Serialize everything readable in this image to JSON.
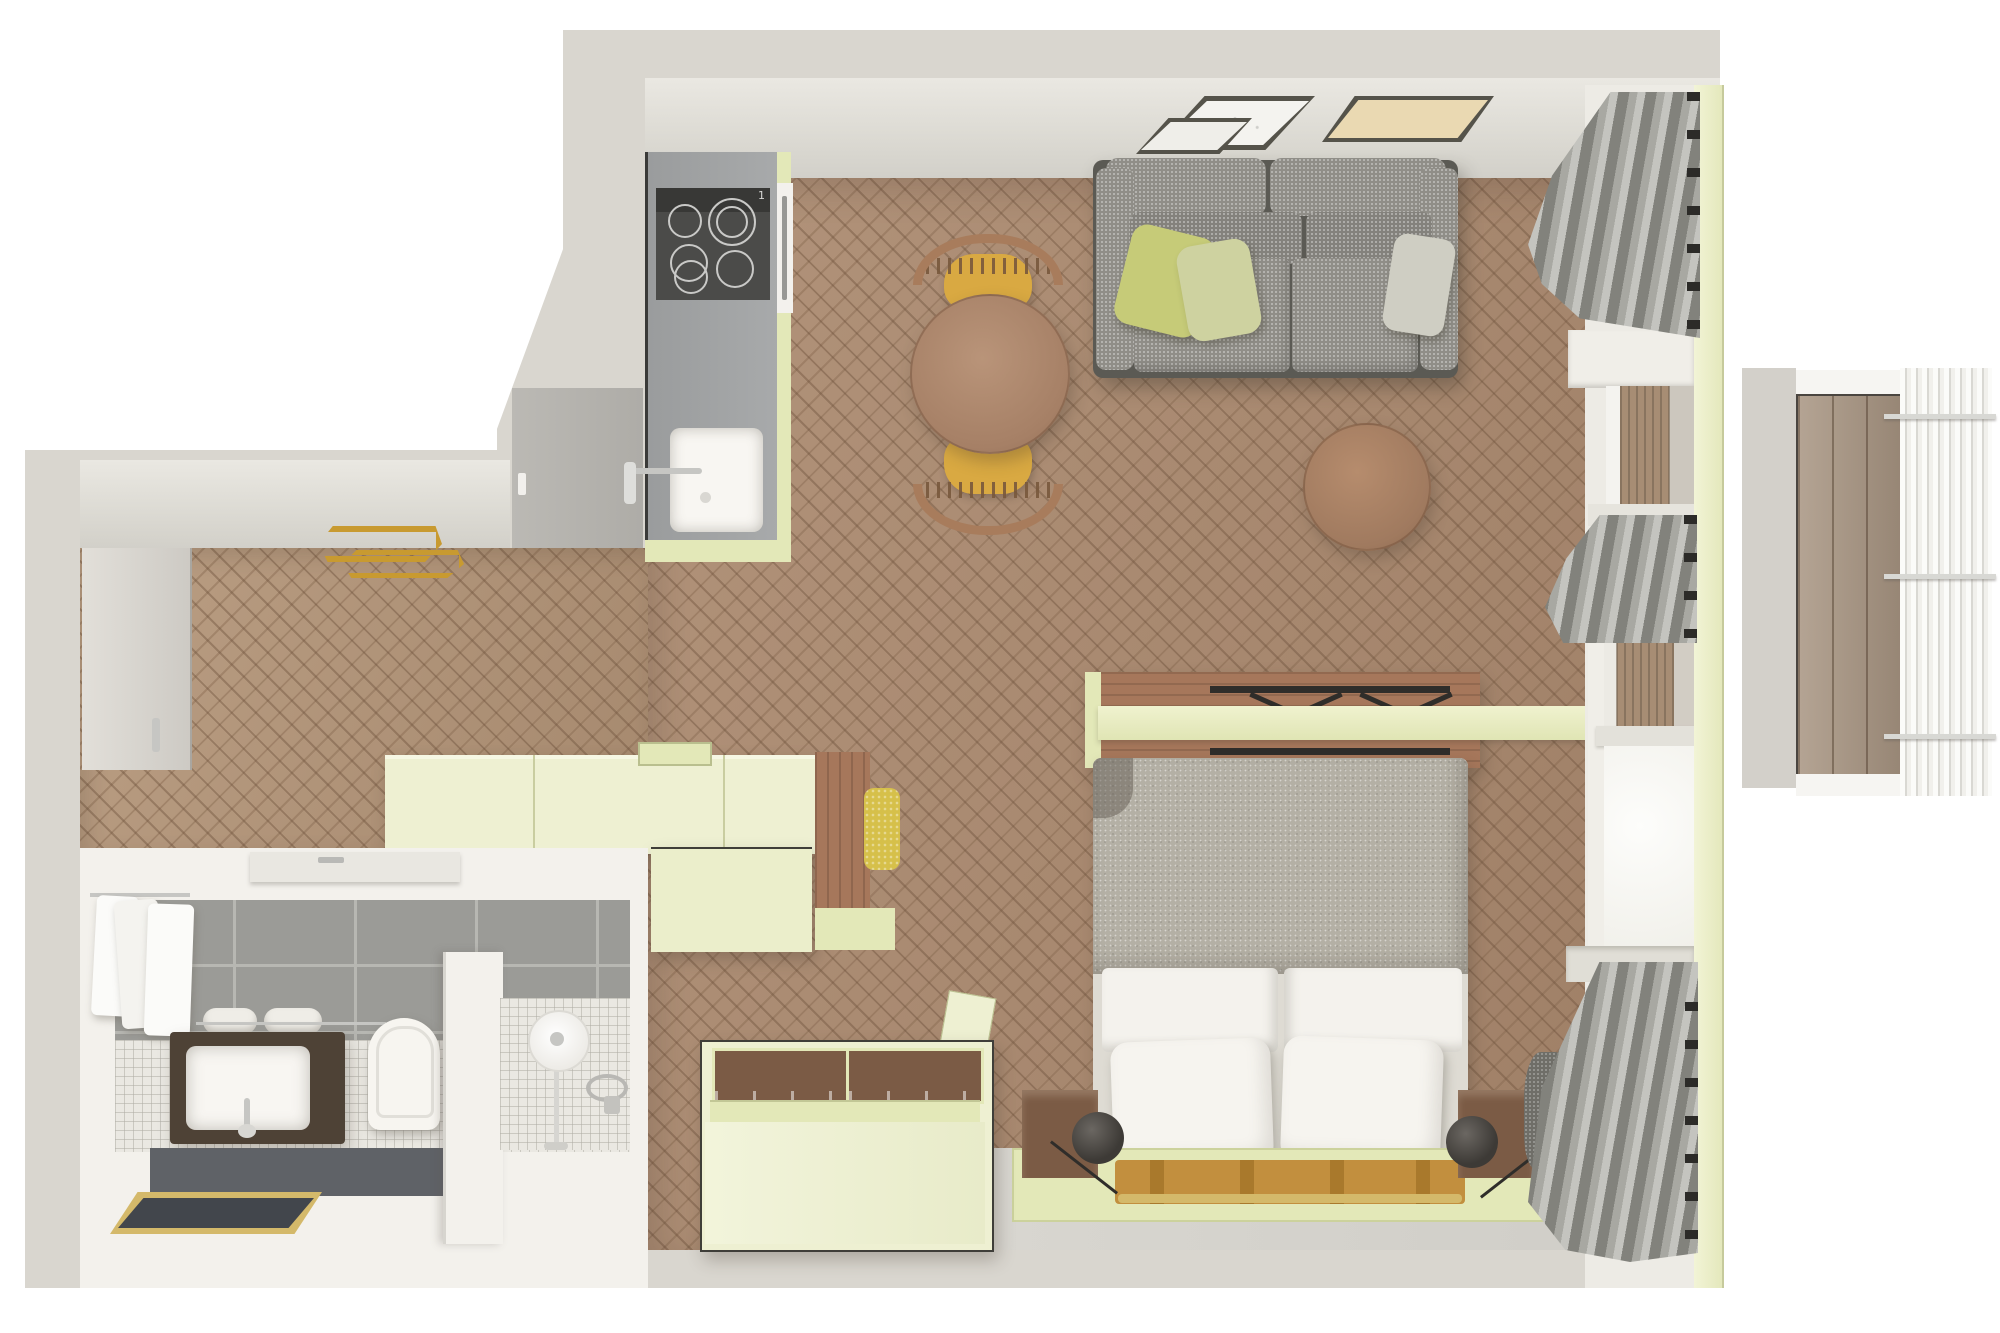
{
  "scene": {
    "type": "3d-top-view-floor-plan",
    "cooktop_indicator": "1",
    "rooms": [
      {
        "name": "kitchen",
        "items": [
          "gray-counter",
          "induction-cooktop",
          "oven",
          "white-sink",
          "faucet",
          "tall-cabinet"
        ]
      },
      {
        "name": "living-area",
        "items": [
          "gray-tweed-sofa",
          "yellow-green-pillows",
          "gray-pillow",
          "round-dining-table",
          "two-chairs-with-yellow-seats",
          "round-coffee-table",
          "leaning-picture-frames",
          "gray-curtains",
          "fold-down-wall-table",
          "pistachio-sideboard",
          "wood-desk-nook-with-yellow-pouf"
        ]
      },
      {
        "name": "sleeping-area",
        "items": [
          "double-bed",
          "gray-knit-blanket",
          "white-pillows",
          "wood-bedside-boxes",
          "black-ball-lamps",
          "leather-bench-with-brass-bar",
          "pistachio-platform",
          "open-wardrobe-with-drawers"
        ]
      },
      {
        "name": "hallway",
        "items": [
          "entrance-door",
          "brass-pendant-lamp",
          "herringbone-floor"
        ]
      },
      {
        "name": "bathroom",
        "items": [
          "towel-radiator",
          "dark-wood-vanity-with-basin",
          "rolled-towels",
          "toilet",
          "walk-in-shower",
          "round-shower-head",
          "partition-wall",
          "brass-frame-mirror",
          "gray-wall-tiles",
          "mosaic-floor"
        ]
      },
      {
        "name": "balcony",
        "items": [
          "wood-plank-deck",
          "white-slat-railing"
        ]
      }
    ]
  },
  "colors": {
    "bg": "#ffffff",
    "wall": "#d9d6cf",
    "wall2": "#cfccc5",
    "floor": "#a9886e",
    "floorhall": "#b29478",
    "grayfloor": "#d6d4ce",
    "green": "#eef0d2",
    "green2": "#e3e8b8",
    "green3": "#ccd29c",
    "counter": "#a0a2a3",
    "cooktop": "#4b4b49",
    "cooktopband": "#383836",
    "burner": "#c9c9c7",
    "sinkwhite": "#f8f6f2",
    "chrome": "#c6c6c3",
    "tablewood": "#ad8971",
    "chairwood": "#a87c5c",
    "chairseat": "#d9a942",
    "sofa": "#908e88",
    "sofadark": "#5b5a54",
    "pillowg": "#c6cb78",
    "pillowg2": "#ced2a0",
    "pillowgray": "#cfcec3",
    "curtain": "#9d9d97",
    "framewhite": "#f4f3ef",
    "framebeige": "#ead9b2",
    "framedge": "#55534a",
    "blanket": "#b4b0a5",
    "sheet": "#f4f2ed",
    "deskwood": "#a6775b",
    "black": "#2f2d2a",
    "tan": "#c28f3e",
    "gold": "#d4b96a",
    "brass": "#c89a30",
    "boxwood": "#7b5b45",
    "lamp": "#3d3a36",
    "throw": "#6f6e68",
    "tile": "#9b9b97",
    "grout": "#b7b7b2",
    "mosaic": "#eae8e2",
    "bathwhite": "#f3f1ec",
    "vanity": "#4e4236",
    "plat": "#5f6267",
    "mirror": "#42464c",
    "towel": "#fbfbf9",
    "winframe": "#edebe5",
    "glass": "#fdfdfb",
    "woodrefl": "#a78d74",
    "deck": "#a89582",
    "rail": "#f6f5f2",
    "balcwall": "#d3d0ca"
  }
}
